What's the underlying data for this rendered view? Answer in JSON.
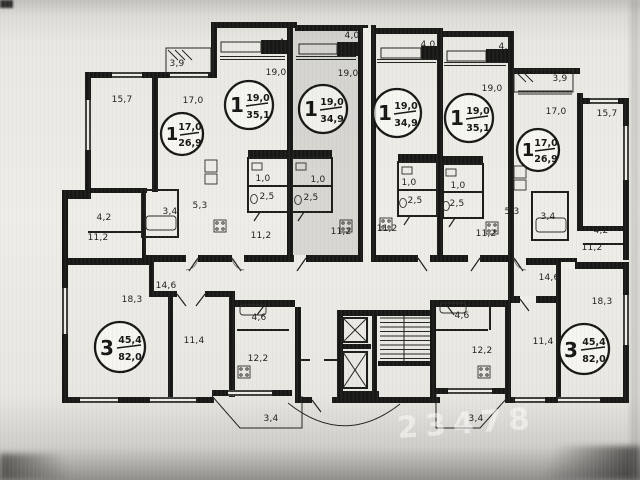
{
  "apartments": [
    {
      "type": "1",
      "living": "17,0",
      "total": "26,9"
    },
    {
      "type": "1",
      "living": "19,0",
      "total": "35,1"
    },
    {
      "type": "1",
      "living": "19,0",
      "total": "34,9"
    },
    {
      "type": "1",
      "living": "19,0",
      "total": "34,9"
    },
    {
      "type": "1",
      "living": "19,0",
      "total": "35,1"
    },
    {
      "type": "1",
      "living": "17,0",
      "total": "26,9"
    },
    {
      "type": "3",
      "living": "45,4",
      "total": "82,0"
    },
    {
      "type": "3",
      "living": "45,4",
      "total": "82,0"
    }
  ],
  "area_labels": [
    "3,9",
    "4,6",
    "4,0",
    "4,0",
    "4,6",
    "3,9",
    "19,0",
    "19,0",
    "19,0",
    "19,0",
    "17,0",
    "17,0",
    "15,7",
    "15,7",
    "1,0",
    "1,0",
    "1,0",
    "1,0",
    "2,5",
    "2,5",
    "2,5",
    "2,5",
    "3,4",
    "3,4",
    "5,3",
    "5,3",
    "4,2",
    "4,2",
    "11,2",
    "11,2",
    "11,2",
    "11,2",
    "11,2",
    "11,2",
    "18,3",
    "18,3",
    "14,6",
    "14,6",
    "11,4",
    "11,4",
    "12,2",
    "12,2",
    "4,6",
    "4,6",
    "3,4",
    "3,4"
  ],
  "watermark": "23478"
}
